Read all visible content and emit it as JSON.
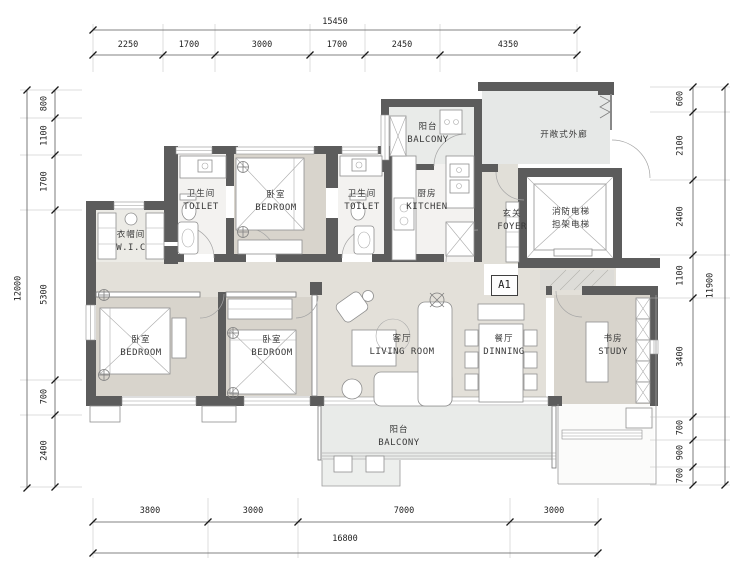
{
  "unit_label": "A1",
  "rooms": {
    "wic": {
      "zh": "衣帽间",
      "en": "W.I.C"
    },
    "toilet1": {
      "zh": "卫生间",
      "en": "TOILET"
    },
    "bedroom_top": {
      "zh": "卧室",
      "en": "BEDROOM"
    },
    "toilet2": {
      "zh": "卫生间",
      "en": "TOILET"
    },
    "kitchen": {
      "zh": "厨房",
      "en": "KITCHEN"
    },
    "balcony_top": {
      "zh": "阳台",
      "en": "BALCONY"
    },
    "foyer": {
      "zh": "玄关",
      "en": "FOYER"
    },
    "corridor": {
      "zh": "开敞式外廊"
    },
    "elevator": {
      "line1": "消防电梯",
      "line2": "担架电梯"
    },
    "bedroom_left": {
      "zh": "卧室",
      "en": "BEDROOM"
    },
    "bedroom_mid": {
      "zh": "卧室",
      "en": "BEDROOM"
    },
    "living": {
      "zh": "客厅",
      "en": "LIVING ROOM"
    },
    "dining": {
      "zh": "餐厅",
      "en": "DINNING"
    },
    "study": {
      "zh": "书房",
      "en": "STUDY"
    },
    "balcony_bottom": {
      "zh": "阳台",
      "en": "BALCONY"
    }
  },
  "dimensions": {
    "top": {
      "total": "15450",
      "segments": [
        "2250",
        "1700",
        "3000",
        "1700",
        "2450",
        "4350"
      ]
    },
    "bottom": {
      "total": "16800",
      "segments": [
        "3800",
        "3000",
        "7000",
        "3000"
      ]
    },
    "left": {
      "total": "12000",
      "segments": [
        "800",
        "1100",
        "1700",
        "5300",
        "700",
        "2400"
      ]
    },
    "right": {
      "total": "11900",
      "segments": [
        "600",
        "2100",
        "2400",
        "1100",
        "3400",
        "700",
        "900",
        "700"
      ]
    }
  },
  "colors": {
    "wall": "#5c5c5c",
    "floor_room": "#d8d4cc",
    "floor_hall": "#e3e0d9",
    "floor_wet": "#f3f2f0",
    "floor_balcony": "#e9ebe9",
    "floor_corridor": "#e6e8e7"
  }
}
